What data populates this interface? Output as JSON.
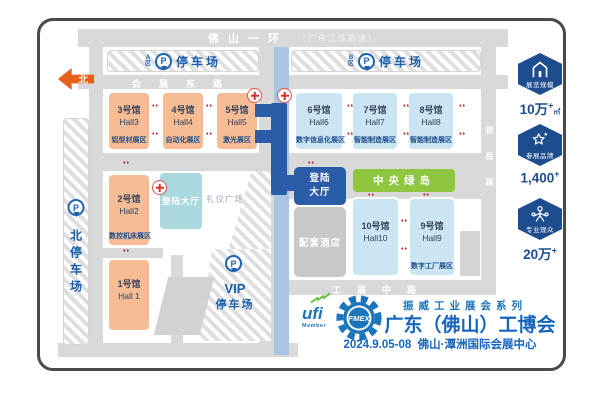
{
  "roads": {
    "ring_road": "佛山一环",
    "ring_road_sub": "（广佛江珠高速）",
    "east_road": "会展东路",
    "center_road": "工展路",
    "mid_road": "工展中路",
    "right_road": "荷岳路"
  },
  "north_arrow": "北",
  "parking": {
    "p": "P",
    "zone_a": {
      "letter": "A",
      "char": "区",
      "label": "停车场"
    },
    "zone_b": {
      "letter": "B",
      "char": "区",
      "label": "停车场"
    },
    "north": {
      "label": "北停车场"
    },
    "vip": {
      "name": "VIP",
      "label": "停车场"
    }
  },
  "halls": [
    {
      "num": "1号馆",
      "en": "Hall 1",
      "zone": ""
    },
    {
      "num": "2号馆",
      "en": "Hall2",
      "zone": "数控机床展区"
    },
    {
      "num": "3号馆",
      "en": "Hall3",
      "zone": "铝型材展区"
    },
    {
      "num": "4号馆",
      "en": "Hall4",
      "zone": "自动化展区"
    },
    {
      "num": "5号馆",
      "en": "Hall5",
      "zone": "激光展区"
    },
    {
      "num": "6号馆",
      "en": "Hall6",
      "zone": "数字信息化展区"
    },
    {
      "num": "7号馆",
      "en": "Hall7",
      "zone": "智能制造展区"
    },
    {
      "num": "8号馆",
      "en": "Hall8",
      "zone": "智能制造展区"
    },
    {
      "num": "9号馆",
      "en": "Hall9",
      "zone": "数字工厂展区"
    },
    {
      "num": "10号馆",
      "en": "Hall10",
      "zone": ""
    }
  ],
  "facilities": {
    "entry_hall_west": "登陆大厅",
    "entry_hall_east_line1": "登陆",
    "entry_hall_east_line2": "大厅",
    "ceremony_plaza": "礼仪广场",
    "central_green": "中央绿岛",
    "hotel": "配套酒店"
  },
  "stats": [
    {
      "icon": "exhibition-scale-icon",
      "label": "展览规模",
      "value": "10万",
      "sup": "+",
      "unit": "㎡"
    },
    {
      "icon": "brands-icon",
      "label": "参展品牌",
      "value": "1,400",
      "sup": "+",
      "unit": ""
    },
    {
      "icon": "visitors-icon",
      "label": "专业观众",
      "value": "20万",
      "sup": "+",
      "unit": ""
    }
  ],
  "footer": {
    "ufi": "ufi",
    "ufi_member": "Member",
    "fmex": "FMEX",
    "series": "振威工业展会系列",
    "title": "广东（佛山）工博会",
    "date": "2024.9.05-08",
    "venue": "佛山·潭洲国际会展中心"
  },
  "colors": {
    "orange_hall": "#f6bd95",
    "blue_hall": "#cbe5f3",
    "teal_hall": "#a9d8de",
    "dark_blue": "#2b5ca8",
    "green_island": "#8ec63f",
    "road_gray": "#d9d9d9",
    "badge_blue": "#1d4c8f",
    "brand_blue": "#1b75bb",
    "accent_orange": "#e8611b"
  }
}
